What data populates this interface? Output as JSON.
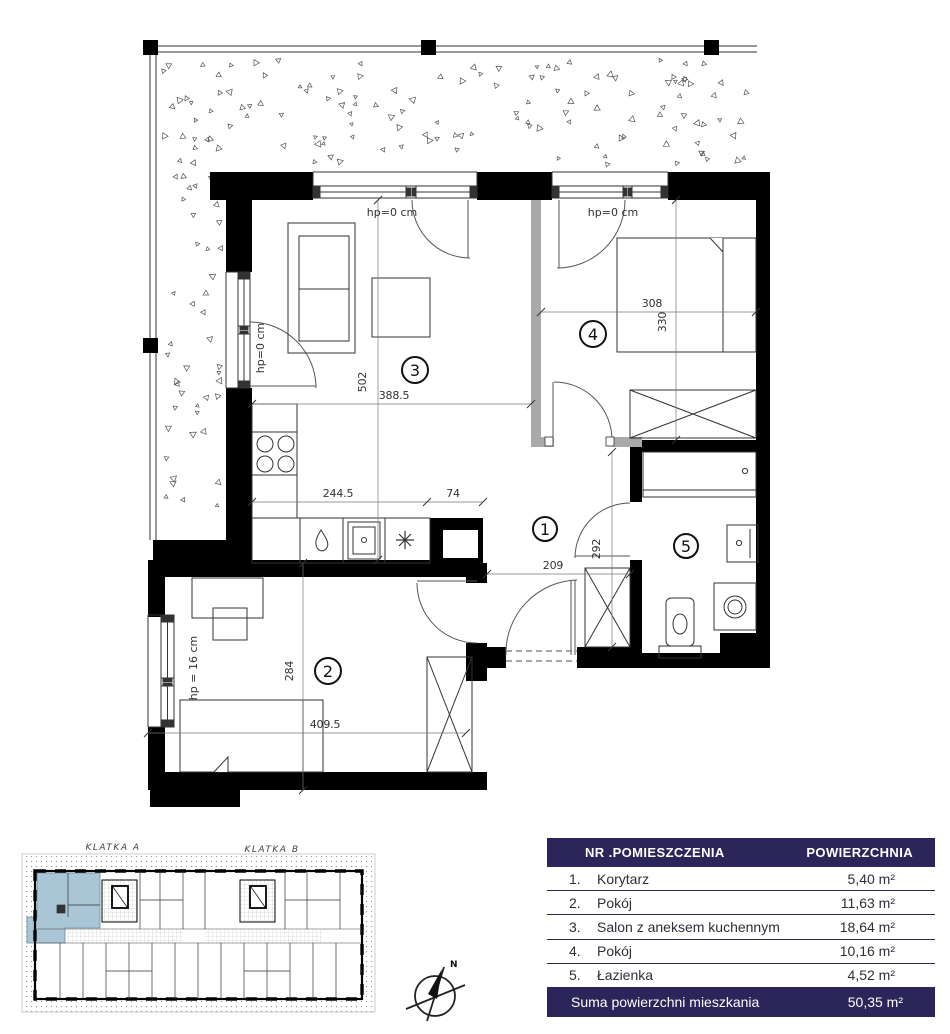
{
  "colors": {
    "navy": "#2b2559",
    "highlight_unit": "#a9c5d6",
    "wall": "#000000",
    "gray_wall": "#a9a9a9"
  },
  "plan": {
    "rooms": {
      "n1": "1",
      "n2": "2",
      "n3": "3",
      "n4": "4",
      "n5": "5"
    },
    "hp": {
      "living_window": "hp=0 cm",
      "bedroom_window": "hp=0 cm",
      "balcony_door": "hp=0 cm",
      "room2_window": "hp = 16 cm"
    },
    "dimensions": {
      "living_w": "388.5",
      "living_h": "502",
      "kitchen_counter": "244.5",
      "shaft_w": "74",
      "bedroom4_w": "308",
      "bedroom4_h": "330",
      "hall_w": "209",
      "hall_h": "292",
      "room2_h": "284",
      "room2_w": "409.5"
    }
  },
  "overview": {
    "klatka_a": "KLATKA A",
    "klatka_b": "KLATKA B"
  },
  "compass": {
    "north": "N"
  },
  "table": {
    "header": {
      "name": "NR .POMIESZCZENIA",
      "area": "POWIERZCHNIA"
    },
    "rows": [
      {
        "num": "1.",
        "name": "Korytarz",
        "area": "5,40 m²"
      },
      {
        "num": "2.",
        "name": "Pokój",
        "area": "11,63 m²"
      },
      {
        "num": "3.",
        "name": "Salon z aneksem kuchennym",
        "area": "18,64 m²"
      },
      {
        "num": "4.",
        "name": "Pokój",
        "area": "10,16 m²"
      },
      {
        "num": "5.",
        "name": "Łazienka",
        "area": "4,52 m²"
      }
    ],
    "footer": {
      "name": "Suma powierzchni mieszkania",
      "area": "50,35 m²"
    }
  }
}
